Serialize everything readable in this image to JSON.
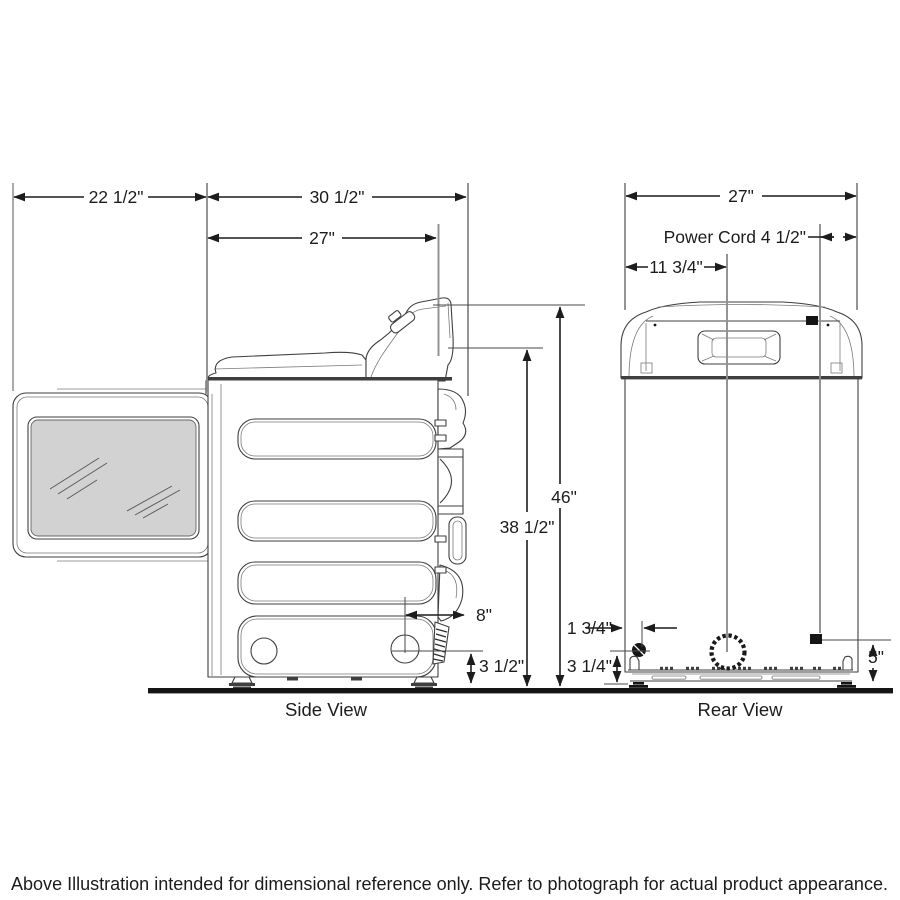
{
  "drawing": {
    "type": "appliance-dimension-diagram",
    "views": {
      "side_label": "Side View",
      "rear_label": "Rear View"
    },
    "dims": {
      "door_clearance": "22 1/2\"",
      "depth_total": "30 1/2\"",
      "depth_cabinet": "27\"",
      "rear_width": "27\"",
      "power_cord": "Power Cord 4 1/2\"",
      "vent_offset_left": "11 3/4\"",
      "height_total": "46\"",
      "height_cabinet": "38 1/2\"",
      "vent_to_rear": "8\"",
      "vent_height_side": "3 1/2\"",
      "inlet_offset": "1 3/4\"",
      "inlet_height": "3 1/4\"",
      "terminal_height": "5\""
    },
    "footer_note": "Above Illustration intended for dimensional reference only. Refer to photograph for actual product appearance.",
    "colors": {
      "line": "#3f3f3f",
      "dimension": "#1c1c1c",
      "extension": "#8f8f8f",
      "glass": "#d2d2d2",
      "floor": "#1a1a1a",
      "background": "#ffffff"
    }
  }
}
